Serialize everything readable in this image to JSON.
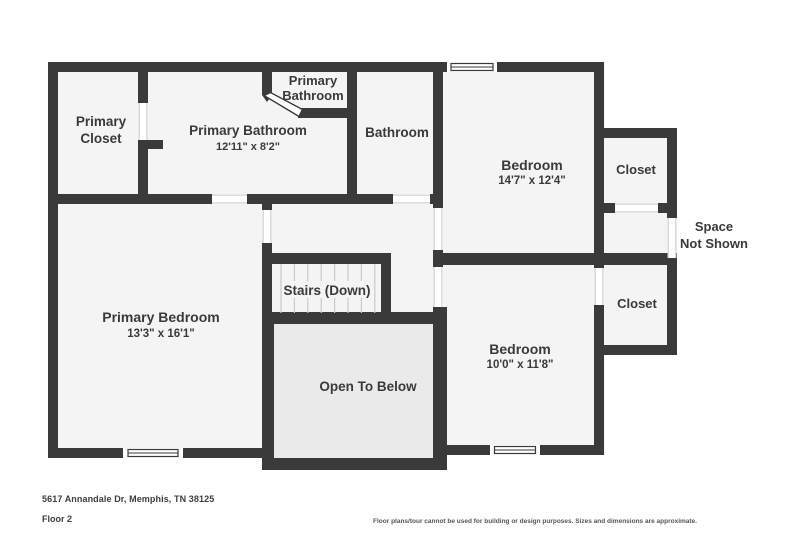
{
  "colors": {
    "wall": "#3a3a3a",
    "room_fill": "#f4f4f4",
    "open_below_fill": "#eaeaea",
    "tread_line": "#c9c9c9",
    "door_edge": "#d2d2d2",
    "label_text": "#3a3a3a"
  },
  "rooms": {
    "primary_closet_l1": "Primary",
    "primary_closet_l2": "Closet",
    "primary_bathroom": "Primary Bathroom",
    "primary_bathroom_dims": "12'11\" x 8'2\"",
    "wc_l1": "Primary",
    "wc_l2": "Bathroom",
    "bathroom": "Bathroom",
    "bedroom1": "Bedroom",
    "bedroom1_dims": "14'7\" x 12'4\"",
    "closet_upper": "Closet",
    "space_l1": "Space",
    "space_l2": "Not Shown",
    "closet_lower": "Closet",
    "bedroom2": "Bedroom",
    "bedroom2_dims": "10'0\" x 11'8\"",
    "primary_bedroom": "Primary Bedroom",
    "primary_bedroom_dims": "13'3\" x 16'1\"",
    "stairs": "Stairs (Down)",
    "open_to_below": "Open To Below"
  },
  "footer": {
    "address": "5617 Annandale Dr, Memphis, TN 38125",
    "floor": "Floor 2",
    "disclaimer": "Floor plans/tour cannot be used for building or design purposes. Sizes and dimensions are approximate."
  }
}
